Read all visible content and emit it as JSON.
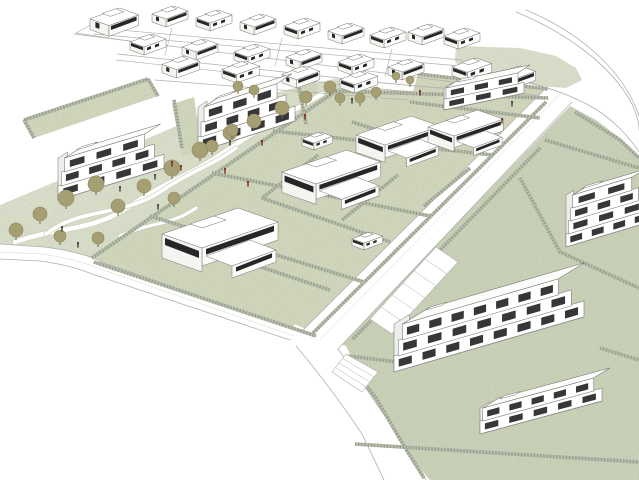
{
  "scene": {
    "title": "",
    "colors": {
      "background": "#ffffff",
      "parkGreen": "#dfe4d0",
      "lawnGreen": "#d6dcc2",
      "lawnGreen2": "#ced6bd",
      "hedgeBase": "#b6bcab",
      "hedgeDark": "#6f7662",
      "treeFill": "#a79f74",
      "treeEdge": "#8d865e",
      "trunk": "#6b654d",
      "personDark": "#3f3f3f",
      "personRed": "#7b2a1c",
      "roadLine": "#b0b0ac",
      "roadLineLight": "#d0d0cc",
      "buildingLine": "#74746f",
      "buildingFill": "#ffffff",
      "faceShade": "#f4f4f1",
      "faceShade2": "#fbfbf9",
      "windowDark": "#262626",
      "pathWhite": "#ffffff",
      "pathEdge": "#c9cfb8"
    },
    "greens": [
      {
        "name": "central-park",
        "fill": "parkGreen",
        "pts": [
          [
            0,
            252
          ],
          [
            0,
            205
          ],
          [
            55,
            182
          ],
          [
            120,
            150
          ],
          [
            200,
            116
          ],
          [
            270,
            94
          ],
          [
            338,
            78
          ],
          [
            350,
            92
          ],
          [
            95,
            263
          ]
        ]
      },
      {
        "name": "villa-block-lawn",
        "fill": "lawnGreen",
        "pts": [
          [
            88,
            258
          ],
          [
            335,
            88
          ],
          [
            552,
            96
          ],
          [
            318,
            338
          ]
        ]
      },
      {
        "name": "east-parcel-lawn",
        "fill": "lawnGreen2",
        "pts": [
          [
            570,
            106
          ],
          [
            596,
            120
          ],
          [
            620,
            138
          ],
          [
            639,
            156
          ],
          [
            639,
            480
          ],
          [
            430,
            480
          ],
          [
            402,
            448
          ],
          [
            370,
            398
          ],
          [
            344,
            352
          ],
          [
            336,
            349
          ]
        ]
      },
      {
        "name": "top-right-green-patch",
        "fill": "parkGreen",
        "pts": [
          [
            456,
            46
          ],
          [
            520,
            48
          ],
          [
            556,
            56
          ],
          [
            576,
            68
          ],
          [
            582,
            80
          ],
          [
            566,
            88
          ],
          [
            540,
            86
          ],
          [
            470,
            74
          ],
          [
            455,
            62
          ]
        ]
      },
      {
        "name": "lawn-building-c",
        "fill": "lawnGreen",
        "pts": [
          [
            418,
            74
          ],
          [
            548,
            89
          ],
          [
            540,
            118
          ],
          [
            410,
            102
          ]
        ]
      },
      {
        "name": "roadside-strip",
        "fill": "lawnGreen",
        "pts": [
          [
            338,
            90
          ],
          [
            425,
            98
          ],
          [
            422,
            106
          ],
          [
            336,
            98
          ]
        ]
      },
      {
        "name": "garden-building-a",
        "fill": "lawnGreen",
        "pts": [
          [
            24,
            120
          ],
          [
            148,
            79
          ],
          [
            158,
            96
          ],
          [
            34,
            138
          ]
        ]
      },
      {
        "name": "garden-building-b-left",
        "fill": "lawnGreen",
        "pts": [
          [
            172,
            104
          ],
          [
            194,
            97
          ],
          [
            202,
            150
          ],
          [
            182,
            156
          ]
        ]
      },
      {
        "name": "garden-building-b-right",
        "fill": "lawnGreen",
        "pts": [
          [
            296,
            84
          ],
          [
            316,
            78
          ],
          [
            322,
            120
          ],
          [
            302,
            126
          ]
        ]
      }
    ],
    "parkPaths": [
      {
        "d": "M15,242 C60,226 92,232 130,206 S190,176 226,151 S282,118 322,94",
        "w": 4.5
      },
      {
        "d": "M46,234 C78,208 124,216 160,192 S208,168 236,148",
        "w": 3.5
      },
      {
        "d": "M120,236 C150,222 170,226 196,208",
        "w": 3
      }
    ],
    "roadFills": [
      {
        "name": "boulevard",
        "d": "M548,86 L572,102 L338,349 L302,331 Z"
      },
      {
        "name": "southwest-road",
        "d": "M0,244 L44,247 Q84,252 104,263 L310,336 L300,352 L92,274 Q70,265 40,261 L0,259 Z"
      },
      {
        "name": "south-road",
        "d": "M296,330 L338,349 Q374,398 404,446 L426,480 L384,480 Q350,420 310,365 Z"
      },
      {
        "name": "junction",
        "d": "M294,324 L346,346 L354,362 L298,356 Z"
      }
    ],
    "roadLines": [
      {
        "d": "M74,34 L330,66 L468,84",
        "w": 0.7
      },
      {
        "d": "M96,28 L462,60",
        "w": 0.7
      },
      {
        "d": "M94,34 L460,66",
        "w": 0.7
      },
      {
        "d": "M118,54 L330,77 Q420,88 505,92 Q530,94 548,98",
        "w": 0.8
      },
      {
        "d": "M116,60 L328,83 Q410,93 470,96",
        "w": 0.7
      },
      {
        "d": "M155,80 L408,100",
        "w": 0.7
      },
      {
        "d": "M76,33 L156,45",
        "w": 0.7
      },
      {
        "d": "M76,33 L96,22",
        "w": 0.7
      },
      {
        "d": "M172,28 L165,55",
        "w": 0.6
      },
      {
        "d": "M282,38 L275,66",
        "w": 0.6
      },
      {
        "d": "M392,49 L385,76",
        "w": 0.6
      },
      {
        "d": "M526,10 C574,30 622,66 639,116",
        "w": 0.8
      },
      {
        "d": "M516,12 C560,30 610,62 632,104 C637,116 639,122 639,130",
        "w": 0.8
      },
      {
        "d": "M470,70 C525,79 570,92 600,112 C616,123 630,138 639,152",
        "w": 0.8
      },
      {
        "d": "M548,86 L302,331",
        "w": 0.8
      },
      {
        "d": "M572,102 L338,349",
        "w": 0.8
      },
      {
        "d": "M560,94 L320,340",
        "w": 0.45,
        "c": "roadLineLight"
      },
      {
        "d": "M0,244 L44,247 Q84,252 104,263 L302,331",
        "w": 0.8
      },
      {
        "d": "M0,259 L40,261 Q70,265 92,274 L290,340",
        "w": 0.8
      },
      {
        "d": "M0,252 L42,254 Q76,259 98,268 L294,336",
        "w": 0.45,
        "c": "roadLineLight"
      },
      {
        "d": "M296,346 Q330,386 362,434 L384,480",
        "w": 0.8
      },
      {
        "d": "M338,349 Q374,398 404,446 L426,480",
        "w": 0.8
      }
    ],
    "parking": [
      {
        "pts": [
          [
            436,
            247
          ],
          [
            458,
            262
          ],
          [
            392,
            334
          ],
          [
            370,
            319
          ]
        ],
        "stalls": 6
      },
      {
        "pts": [
          [
            346,
            354
          ],
          [
            378,
            372
          ],
          [
            362,
            392
          ],
          [
            332,
            372
          ]
        ],
        "stalls": 4
      }
    ],
    "hedges": [
      {
        "pts": [
          [
            92,
            258
          ],
          [
            336,
            91
          ]
        ]
      },
      {
        "pts": [
          [
            336,
            91
          ],
          [
            548,
            98
          ]
        ]
      },
      {
        "pts": [
          [
            546,
            102
          ],
          [
            312,
            334
          ]
        ]
      },
      {
        "pts": [
          [
            94,
            262
          ],
          [
            316,
            336
          ]
        ]
      },
      {
        "pts": [
          [
            212,
            173
          ],
          [
            430,
            216
          ]
        ]
      },
      {
        "pts": [
          [
            273,
            131
          ],
          [
            493,
            155
          ]
        ]
      },
      {
        "pts": [
          [
            150,
            216
          ],
          [
            364,
            282
          ]
        ]
      },
      {
        "pts": [
          [
            318,
            155
          ],
          [
            262,
            198
          ]
        ]
      },
      {
        "pts": [
          [
            398,
            175
          ],
          [
            342,
            220
          ]
        ]
      },
      {
        "pts": [
          [
            424,
            206
          ],
          [
            470,
            168
          ]
        ]
      },
      {
        "pts": [
          [
            262,
            198
          ],
          [
            390,
            242
          ]
        ]
      },
      {
        "pts": [
          [
            180,
            240
          ],
          [
            330,
            290
          ]
        ]
      },
      {
        "pts": [
          [
            352,
            122
          ],
          [
            428,
            146
          ]
        ]
      },
      {
        "pts": [
          [
            24,
            120
          ],
          [
            148,
            79
          ]
        ]
      },
      {
        "pts": [
          [
            24,
            120
          ],
          [
            34,
            138
          ]
        ]
      },
      {
        "pts": [
          [
            148,
            79
          ],
          [
            158,
            96
          ]
        ]
      },
      {
        "pts": [
          [
            174,
            100
          ],
          [
            182,
            148
          ]
        ]
      },
      {
        "pts": [
          [
            298,
            82
          ],
          [
            306,
            124
          ]
        ]
      },
      {
        "pts": [
          [
            418,
            74
          ],
          [
            548,
            89
          ]
        ]
      },
      {
        "pts": [
          [
            410,
            102
          ],
          [
            540,
            118
          ]
        ]
      },
      {
        "pts": [
          [
            545,
            140
          ],
          [
            639,
            168
          ]
        ]
      },
      {
        "pts": [
          [
            520,
            178
          ],
          [
            560,
            252
          ],
          [
            639,
            288
          ]
        ]
      },
      {
        "pts": [
          [
            540,
            148
          ],
          [
            352,
            340
          ]
        ]
      },
      {
        "pts": [
          [
            346,
            360
          ],
          [
            376,
            398
          ],
          [
            404,
            446
          ],
          [
            424,
            478
          ]
        ]
      },
      {
        "pts": [
          [
            575,
            112
          ],
          [
            620,
            140
          ],
          [
            639,
            158
          ]
        ]
      },
      {
        "pts": [
          [
            348,
            356
          ],
          [
            398,
            362
          ]
        ]
      },
      {
        "pts": [
          [
            600,
            348
          ],
          [
            639,
            360
          ]
        ]
      },
      {
        "pts": [
          [
            355,
            444
          ],
          [
            639,
            462
          ]
        ]
      }
    ],
    "houses": [
      [
        90,
        8,
        1.35,
        0
      ],
      [
        152,
        6,
        1,
        0
      ],
      [
        196,
        10,
        1,
        1
      ],
      [
        240,
        14,
        1,
        0
      ],
      [
        284,
        18,
        1,
        1
      ],
      [
        328,
        23,
        1,
        0
      ],
      [
        370,
        27,
        1,
        1
      ],
      [
        408,
        24,
        1,
        0
      ],
      [
        444,
        28,
        1,
        1
      ],
      [
        130,
        34,
        1,
        1
      ],
      [
        182,
        39,
        1,
        0
      ],
      [
        234,
        44,
        1,
        1
      ],
      [
        286,
        49,
        1,
        0
      ],
      [
        338,
        54,
        1,
        1
      ],
      [
        388,
        59,
        1,
        0
      ],
      [
        162,
        56,
        1.05,
        0
      ],
      [
        222,
        61,
        1.05,
        1
      ],
      [
        282,
        66,
        1.05,
        0
      ],
      [
        340,
        71,
        1.05,
        1
      ],
      [
        452,
        58,
        1.1,
        1
      ],
      [
        496,
        66,
        1.1,
        0
      ]
    ],
    "sheds": [
      [
        302,
        132,
        0.85,
        1
      ],
      [
        198,
        218,
        0.85,
        0
      ],
      [
        352,
        232,
        0.85,
        1
      ]
    ],
    "villas": [
      [
        162,
        208,
        2.0
      ],
      [
        282,
        150,
        1.7
      ],
      [
        356,
        116,
        1.45
      ],
      [
        428,
        110,
        1.3
      ]
    ],
    "apartments": [
      {
        "name": "apartment-c",
        "x": 444,
        "y": 110,
        "L": 80,
        "s": -0.21,
        "floors": 2,
        "fh": 11,
        "shrink": 8,
        "back": [
          12,
          -8
        ]
      },
      {
        "name": "apartment-b",
        "x": 198,
        "y": 152,
        "L": 97,
        "s": -0.32,
        "floors": 3,
        "fh": 15,
        "shrink": 12,
        "back": [
          15,
          -10
        ]
      },
      {
        "name": "apartment-a",
        "x": 58,
        "y": 200,
        "L": 106,
        "s": -0.3,
        "floors": 3,
        "fh": 14,
        "shrink": 13,
        "back": [
          16,
          -10
        ]
      },
      {
        "name": "apartment-d",
        "x": 566,
        "y": 247,
        "L": 86,
        "s": -0.3,
        "floors": 4,
        "fh": 13,
        "shrink": 9,
        "back": [
          13,
          -8
        ]
      },
      {
        "name": "apartment-e-main",
        "x": 394,
        "y": 372,
        "L": 190,
        "s": -0.29,
        "floors": 3,
        "fh": 16,
        "shrink": 17,
        "back": [
          26,
          -16
        ]
      },
      {
        "name": "apartment-e-wing",
        "x": 480,
        "y": 434,
        "L": 122,
        "s": -0.27,
        "floors": 2,
        "fh": 13,
        "shrink": 11,
        "back": [
          16,
          -10
        ]
      }
    ],
    "trees": [
      [
        16,
        230,
        7
      ],
      [
        40,
        214,
        7
      ],
      [
        66,
        198,
        8
      ],
      [
        96,
        184,
        8
      ],
      [
        60,
        236,
        6
      ],
      [
        118,
        206,
        7
      ],
      [
        98,
        238,
        6
      ],
      [
        144,
        186,
        7
      ],
      [
        172,
        168,
        8
      ],
      [
        200,
        150,
        8
      ],
      [
        174,
        198,
        6
      ],
      [
        230,
        133,
        7
      ],
      [
        254,
        121,
        7
      ],
      [
        282,
        108,
        7
      ],
      [
        306,
        97,
        6
      ],
      [
        330,
        87,
        6
      ],
      [
        238,
        86,
        5
      ],
      [
        254,
        90,
        5
      ],
      [
        360,
        98,
        5
      ],
      [
        376,
        92,
        5
      ],
      [
        396,
        76,
        4
      ],
      [
        410,
        80,
        4
      ],
      [
        340,
        98,
        5
      ],
      [
        212,
        146,
        6
      ],
      [
        232,
        130,
        6
      ]
    ],
    "people": {
      "dark": [
        [
          62,
          228
        ],
        [
          78,
          244
        ],
        [
          120,
          188
        ],
        [
          155,
          176
        ],
        [
          158,
          206
        ],
        [
          230,
          142
        ],
        [
          352,
          100
        ],
        [
          512,
          103
        ]
      ],
      "red": [
        [
          172,
          163
        ],
        [
          181,
          167
        ],
        [
          248,
          183
        ],
        [
          262,
          142
        ],
        [
          225,
          170
        ],
        [
          305,
          116
        ],
        [
          420,
          92
        ],
        [
          502,
          120
        ]
      ]
    }
  }
}
